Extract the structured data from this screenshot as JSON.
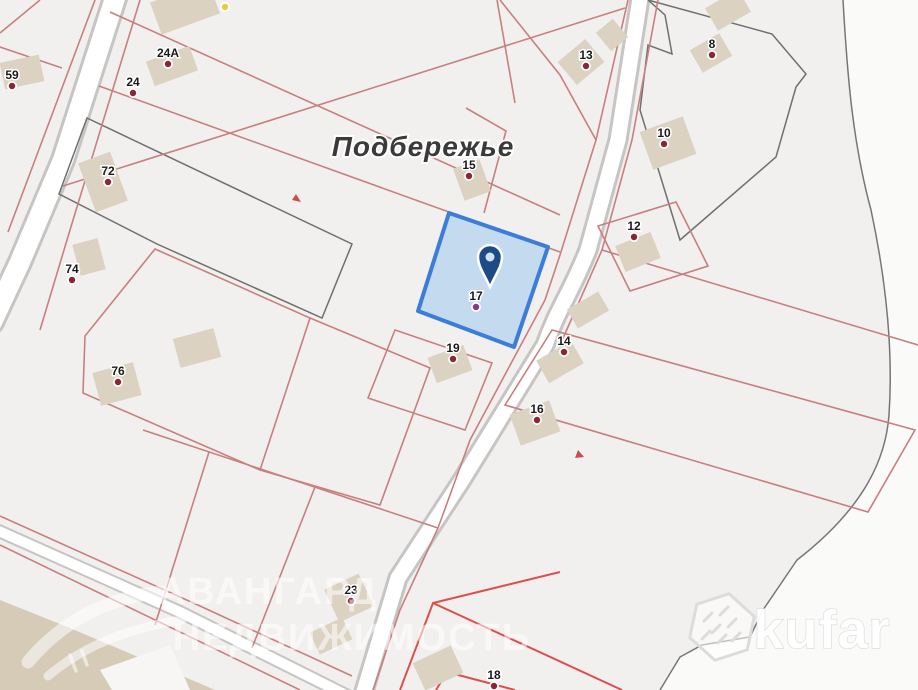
{
  "canvas": {
    "w": 918,
    "h": 690,
    "bg": "#f1f0ee"
  },
  "regions": {
    "east_fill": "#fafaf9",
    "east_path": "M843,0 C847,70 852,140 871,210 C887,285 893,355 889,415 C886,455 868,505 797,560 L763,610 L750,637 L702,645 L680,657 L660,690 L918,690 L918,0 Z",
    "east_boundary": "M843,0 C847,70 852,140 871,210 C887,285 893,355 889,415 C886,455 868,505 797,560 L763,610 L750,637 L702,645 L680,657 L660,690",
    "east_boundary_color": "#76757a",
    "tan_points": "0,600 70,628 150,662 215,690 0,690",
    "tan_fill": "#d5cbb7",
    "white_cut_points": "100,670 170,645 190,690 112,690",
    "white_cut_fill": "#f7f6f4"
  },
  "road_colors": {
    "casing": "#c6c5c3",
    "inner": "#ffffff"
  },
  "roads": [
    {
      "name": "left-road",
      "d": "M117,-8 L63,160 L20,262 L-8,322",
      "casing": 26,
      "inner": 20
    },
    {
      "name": "central-road",
      "d": "M641,-8 L618,140 L588,250 C570,295 558,308 545,345 L462,480 L398,578 L362,698",
      "casing": 21,
      "inner": 15
    },
    {
      "name": "bottom-road",
      "d": "M-8,528 L180,612 L352,698",
      "casing": 14,
      "inner": 10
    }
  ],
  "lines": {
    "pink": {
      "color": "#c87f7f",
      "width": 1.6,
      "paths": [
        "M95,0 L8,232",
        "M40,0 L0,33",
        "M0,47 L62,68",
        "M140,0 L70,230 L40,330",
        "M110,12 L560,215",
        "M99,86 L560,252",
        "M63,186 L625,8",
        "M497,0 L515,103",
        "M466,108 L506,131 L484,213",
        "M628,0 L596,140 L560,255 L545,300",
        "M545,300 L470,440 L438,528 L400,610 L373,690",
        "M500,0 L560,75 L596,140",
        "M658,0 L632,140 L602,250 L560,345",
        "M602,250 L918,345",
        "M598,226 L676,202 L708,266 L630,291 Z",
        "M552,330 L915,430 L868,512 L505,405 Z",
        "M155,249 L310,318 L260,470 L83,393 L85,336 Z",
        "M310,318 L430,368 L380,505 L260,470",
        "M395,330 L492,363 L465,430 L368,398 Z",
        "M143,430 L438,528",
        "M209,452 L155,625",
        "M315,487 L252,648",
        "M0,516 L200,606 L352,676",
        "M0,545 L300,690"
      ]
    },
    "dark": {
      "color": "#6f6f6d",
      "width": 1.5,
      "paths": [
        "M87,118 L352,244 L322,318 L157,244 L59,194 Z",
        "M648,0 L772,34 L806,74 L796,87 L776,157 L680,240 L640,110 L648,45 L672,54 L665,15 Z"
      ]
    },
    "bright": {
      "color": "#dd4f4f",
      "width": 2,
      "paths": [
        "M560,572 L433,603 L400,690",
        "M433,603 L622,690",
        "M447,672 L436,690",
        "M447,672 L515,690"
      ]
    }
  },
  "ticks": {
    "color": "#c94f4f",
    "paths": [
      "M296,194 l5,8 l-9,-2 z",
      "M578,450 l6,7 l-9,1 z"
    ]
  },
  "buildings": {
    "fill": "#dbd2c1",
    "items": [
      [
        22,
        72,
        40,
        27,
        -12
      ],
      [
        185,
        8,
        62,
        34,
        -20
      ],
      [
        172,
        66,
        46,
        26,
        -20
      ],
      [
        103,
        182,
        34,
        52,
        -20
      ],
      [
        89,
        257,
        26,
        32,
        -15
      ],
      [
        117,
        384,
        42,
        34,
        -15
      ],
      [
        197,
        348,
        42,
        30,
        -15
      ],
      [
        472,
        180,
        28,
        34,
        -20
      ],
      [
        581,
        62,
        36,
        30,
        -40
      ],
      [
        612,
        35,
        22,
        24,
        -40
      ],
      [
        711,
        53,
        34,
        26,
        -30
      ],
      [
        728,
        10,
        38,
        26,
        -30
      ],
      [
        668,
        143,
        46,
        40,
        -20
      ],
      [
        638,
        252,
        38,
        28,
        -22
      ],
      [
        560,
        362,
        40,
        26,
        -30
      ],
      [
        588,
        310,
        36,
        22,
        -30
      ],
      [
        450,
        364,
        38,
        27,
        -20
      ],
      [
        535,
        423,
        42,
        33,
        -20
      ],
      [
        349,
        598,
        38,
        36,
        -25
      ],
      [
        331,
        636,
        36,
        24,
        -25
      ],
      [
        438,
        668,
        42,
        30,
        -25
      ]
    ]
  },
  "blue_parcel": {
    "points": "449,213 548,247 514,347 418,311",
    "fill": "#bcd7ef",
    "opacity": 0.85,
    "stroke": "#3b7dd8",
    "stroke_width": 4
  },
  "pin": {
    "cx": 490,
    "cy": 257,
    "body_path": "M490,287 C483,272 478,266 478,257 A12,12 0 1 1 502,257 C502,266 497,272 490,287 Z",
    "body": "#1c4b87",
    "inner": "#cfe3f3",
    "outline": "#ffffff"
  },
  "place_label": {
    "text": "Подбережье",
    "x": 423,
    "y": 156,
    "size": 28,
    "color": "#3a3a3a"
  },
  "markers": {
    "dot_default": "#8e2333",
    "label_color": "#1a1a1a",
    "items": [
      {
        "label": "59",
        "x": 12,
        "y": 75
      },
      {
        "label": "24A",
        "x": 168,
        "y": 53
      },
      {
        "label": "24",
        "x": 133,
        "y": 82
      },
      {
        "label": "72",
        "x": 108,
        "y": 171
      },
      {
        "label": "74",
        "x": 72,
        "y": 269
      },
      {
        "label": "76",
        "x": 118,
        "y": 371
      },
      {
        "label": "13",
        "x": 586,
        "y": 55
      },
      {
        "label": "8",
        "x": 712,
        "y": 44
      },
      {
        "label": "10",
        "x": 664,
        "y": 133
      },
      {
        "label": "12",
        "x": 634,
        "y": 226
      },
      {
        "label": "15",
        "x": 469,
        "y": 165
      },
      {
        "label": "17",
        "x": 476,
        "y": 296,
        "color": "#8a3390"
      },
      {
        "label": "19",
        "x": 453,
        "y": 348
      },
      {
        "label": "14",
        "x": 564,
        "y": 341
      },
      {
        "label": "16",
        "x": 537,
        "y": 409
      },
      {
        "label": "23",
        "x": 351,
        "y": 590
      },
      {
        "label": "18",
        "x": 494,
        "y": 675
      },
      {
        "label": "",
        "x": 225,
        "y": -4,
        "color": "#e7cb45"
      }
    ]
  },
  "watermarks": {
    "avangard": {
      "line1": "АВАНГАРД",
      "line2": "НЕДВИЖИМОСТЬ",
      "x1": 268,
      "y1": 604,
      "x2": 352,
      "y2": 650,
      "size": 38,
      "color": "rgba(255,255,255,0.55)"
    },
    "bird": {
      "color": "rgba(255,255,255,0.55)",
      "paths": [
        "M28,662 Q80,600 162,592",
        "M48,676 Q100,632 182,620"
      ],
      "feet": [
        "M70,655 l6,16",
        "M82,651 l5,14"
      ]
    },
    "kufar": {
      "text": "kufar",
      "x": 822,
      "y": 648,
      "size": 54,
      "color": "rgba(255,255,255,0.95)",
      "outline": "#d9d9d9",
      "hex_cx": 722,
      "hex_cy": 627,
      "hex_r": 34,
      "hex_stroke": "#dcdcdc"
    }
  }
}
